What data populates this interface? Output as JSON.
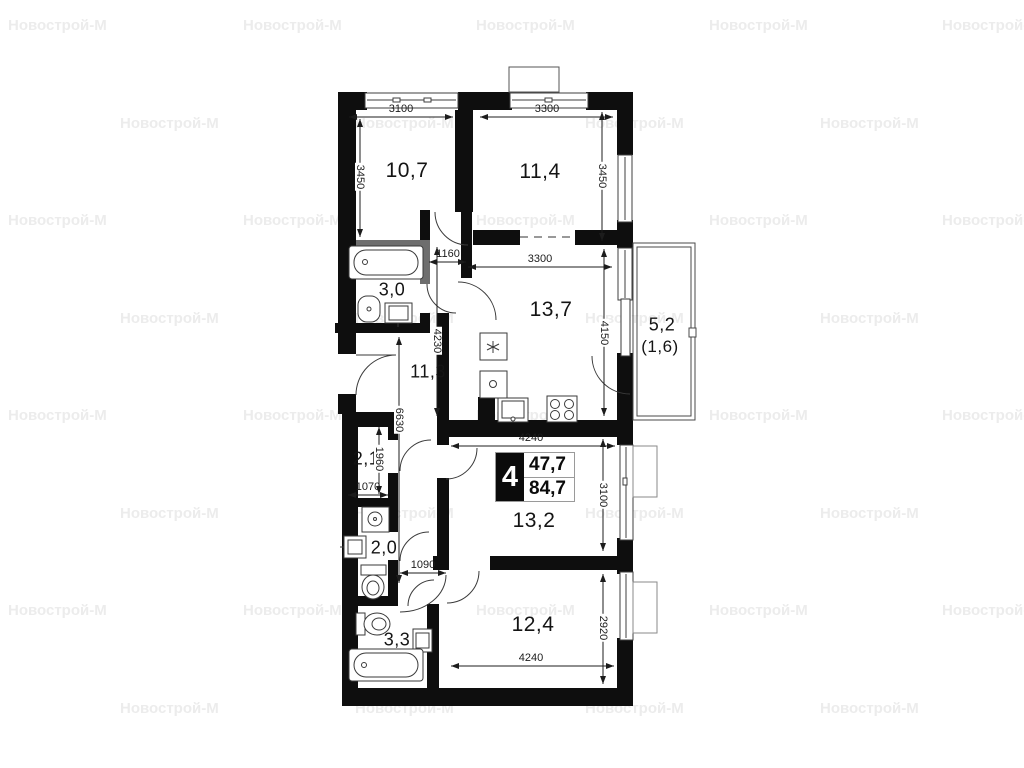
{
  "watermark": {
    "text": "Новострой-М",
    "color": "#ececec"
  },
  "info_badge": {
    "rooms_count": "4",
    "living_area": "47,7",
    "total_area": "84,7"
  },
  "rooms": {
    "room1": {
      "area": "10,7"
    },
    "room2": {
      "area": "11,4"
    },
    "bathroom_top": {
      "area": "3,0"
    },
    "hallway": {
      "area": "11,3"
    },
    "kitchen": {
      "area": "13,7"
    },
    "balcony": {
      "area": "5,2",
      "area_coeff": "(1,6)"
    },
    "storage": {
      "area": "2,1"
    },
    "wc": {
      "area": "2,0"
    },
    "living": {
      "area": "13,2"
    },
    "bathroom_bottom": {
      "area": "3,3"
    },
    "bedroom": {
      "area": "12,4"
    }
  },
  "dimensions_mm": {
    "room1_width": "3100",
    "room1_height": "3450",
    "room2_width": "3300",
    "room2_height": "3450",
    "hall_opening_width": "1160",
    "kitchen_width": "3300",
    "hallway_height": "4230",
    "kitchen_height": "4150",
    "corridor_total": "6630",
    "storage_height": "1960",
    "storage_width": "1070",
    "living_width": "4240",
    "living_height": "3100",
    "wc_door_width": "1090",
    "bedroom_height": "2920",
    "bedroom_width": "4240"
  }
}
